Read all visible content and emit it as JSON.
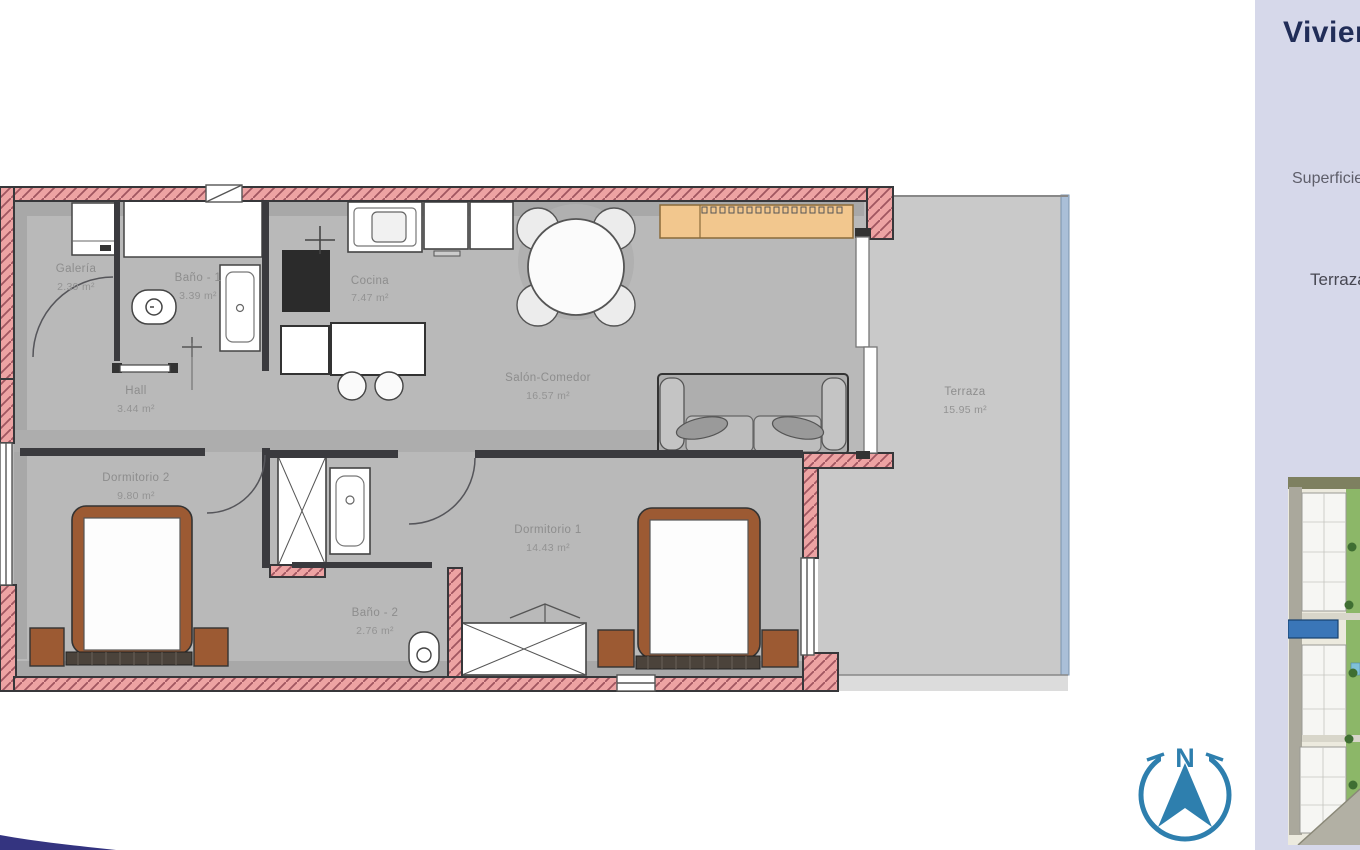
{
  "plan": {
    "rooms": [
      {
        "name": "Galería",
        "area": "2.39 m²"
      },
      {
        "name": "Baño - 1",
        "area": "3.39 m²"
      },
      {
        "name": "Cocina",
        "area": "7.47 m²"
      },
      {
        "name": "Salón-Comedor",
        "area": "16.57 m²"
      },
      {
        "name": "Hall",
        "area": "3.44 m²"
      },
      {
        "name": "Dormitorio 2",
        "area": "9.80 m²"
      },
      {
        "name": "Dormitorio 1",
        "area": "14.43 m²"
      },
      {
        "name": "Baño - 2",
        "area": "2.76 m²"
      },
      {
        "name": "Terraza",
        "area": "15.95 m²"
      }
    ]
  },
  "panel": {
    "title": "Vivienda",
    "fields": [
      "Superficie",
      "Terraza"
    ]
  },
  "compass": {
    "north": "N"
  },
  "colors": {
    "wall_fill": "#eda3a3",
    "wall_hatch": "#a05560",
    "interior_floor": "#b9b9b9",
    "terrace_floor": "#c9c9c9",
    "terrace_railing": "#aabfd8",
    "bed_wood": "#9c5a33",
    "sideboard_orange": "#f2c78e",
    "compass_blue": "#2e7fae",
    "panel_bg": "#d6d8ea",
    "panel_title": "#212d58",
    "site_highlight": "#3a76b8",
    "swoosh_navy": "#343480"
  }
}
